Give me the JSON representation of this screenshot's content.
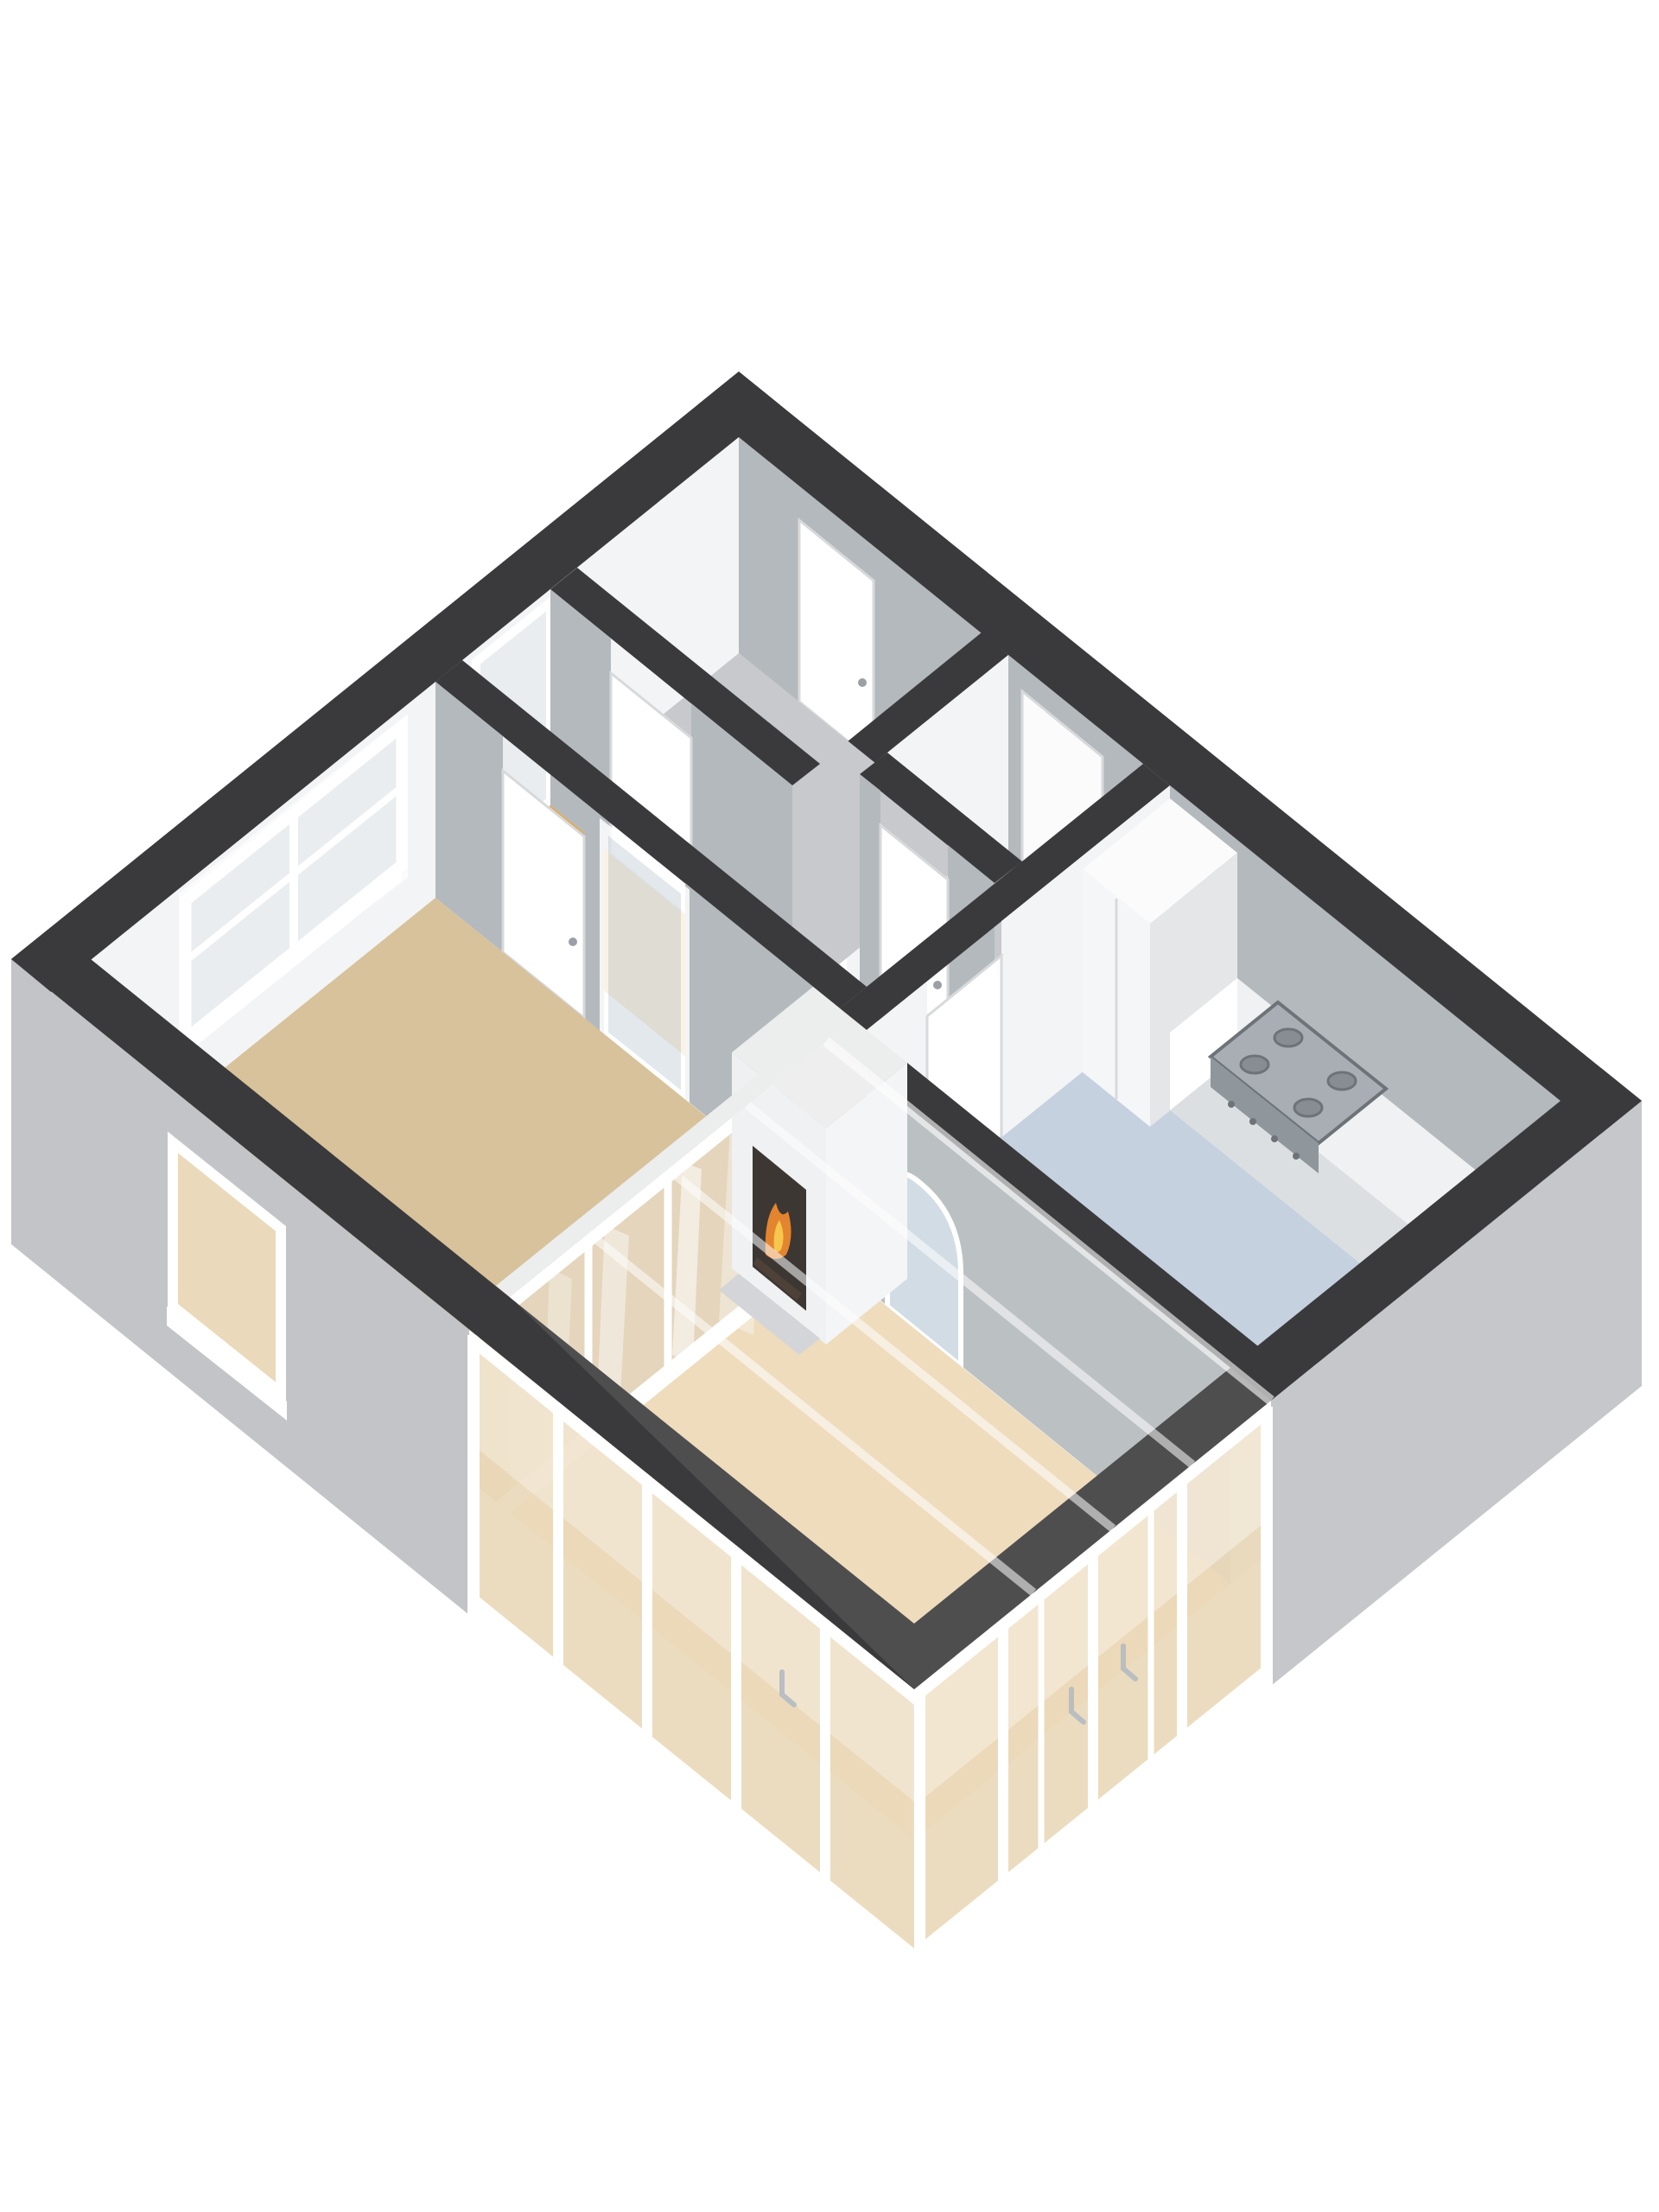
{
  "scene": {
    "type": "3d-floorplan-render",
    "view": "isometric-birdseye",
    "background": "#ffffff"
  },
  "rooms": [
    {
      "id": "vestibule",
      "floor_color_key": "floor_gray"
    },
    {
      "id": "closet",
      "floor_color_key": "floor_gray"
    },
    {
      "id": "hallway",
      "floor_color_key": "floor_hall"
    },
    {
      "id": "living-room",
      "floor_color_key": "floor_living"
    },
    {
      "id": "kitchen",
      "floor_color_key": "floor_kitchen"
    },
    {
      "id": "conservatory",
      "floor_color_key": "floor_conservatory"
    }
  ],
  "colors": {
    "background": "#ffffff",
    "cap": "#3a3a3c",
    "cap_white": "#eceded",
    "ext_face": "#c6c7ca",
    "ext_face_sw": "#c3c4c7",
    "face_bright": "#f3f4f5",
    "face_lit": "#eef0f1",
    "face_light": "#e8eaec",
    "face_mid": "#d9dcde",
    "face_gray": "#b4b9bd",
    "floor_living": "#d7c29c",
    "floor_conservatory": "#ecd9b6",
    "floor_hall": "#e2aa52",
    "floor_gray": "#c7c9cc",
    "floor_kitchen": "#c5d1df",
    "glass_pale": "#e9edf0",
    "glass_panel": "#dfe5ea",
    "glass_beige": "#ead9ba",
    "arch_view": "#cdd8e3",
    "white": "#ffffff",
    "near_white": "#fbfbfc",
    "counter_top": "#f0f1f2",
    "counter_front": "#dcdfe1",
    "counter_front2": "#e6e8ea",
    "cabinet_sw": "#f5f6f7",
    "cabinet_se": "#e4e6e8",
    "cabinet_top": "#fbfbfc",
    "stove_top": "#a8aeb4",
    "stove_front": "#8f969c",
    "burner": "#878d93",
    "burner_rim": "#6d7378",
    "sink_rim": "#c6cbcf",
    "sink_basin": "#9fa6ac",
    "metal": "#b9bec2",
    "fire_dark": "#27211d",
    "fire_orange": "#e07818",
    "fire_yellow": "#f6c03a",
    "log": "#3a2d22",
    "hearth": "#cfd1d4",
    "door_stroke": "#d7d9db",
    "handle": "#9aa0a5"
  }
}
